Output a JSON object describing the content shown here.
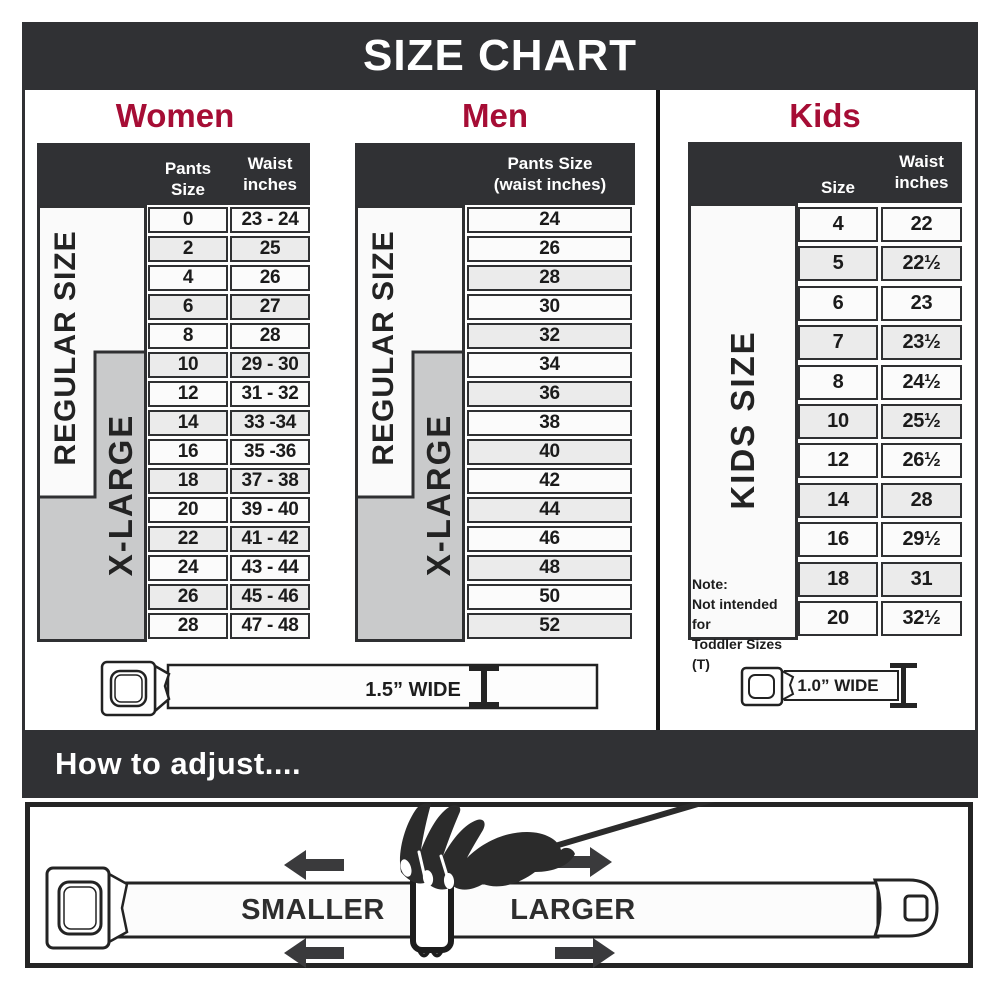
{
  "title": "SIZE CHART",
  "colors": {
    "accent": "#A60D35",
    "charcoal": "#303134",
    "gray_block": "#C9CACB"
  },
  "sections": {
    "women": {
      "heading": "Women",
      "col_size": "Pants Size",
      "col_waist_1": "Waist",
      "col_waist_2": "inches",
      "regular": "REGULAR SIZE",
      "xlarge": "X-LARGE",
      "rows": [
        {
          "size": "0",
          "waist": "23 - 24"
        },
        {
          "size": "2",
          "waist": "25"
        },
        {
          "size": "4",
          "waist": "26"
        },
        {
          "size": "6",
          "waist": "27"
        },
        {
          "size": "8",
          "waist": "28"
        },
        {
          "size": "10",
          "waist": "29 - 30"
        },
        {
          "size": "12",
          "waist": "31 - 32"
        },
        {
          "size": "14",
          "waist": "33 -34"
        },
        {
          "size": "16",
          "waist": "35 -36"
        },
        {
          "size": "18",
          "waist": "37 - 38"
        },
        {
          "size": "20",
          "waist": "39 - 40"
        },
        {
          "size": "22",
          "waist": "41 - 42"
        },
        {
          "size": "24",
          "waist": "43 - 44"
        },
        {
          "size": "26",
          "waist": "45 - 46"
        },
        {
          "size": "28",
          "waist": "47 - 48"
        }
      ]
    },
    "men": {
      "heading": "Men",
      "col_1": "Pants Size",
      "col_2": "(waist inches)",
      "regular": "REGULAR SIZE",
      "xlarge": "X-LARGE",
      "rows": [
        "24",
        "26",
        "28",
        "30",
        "32",
        "34",
        "36",
        "38",
        "40",
        "42",
        "44",
        "46",
        "48",
        "50",
        "52"
      ]
    },
    "kids": {
      "heading": "Kids",
      "col_size": "Size",
      "col_waist_1": "Waist",
      "col_waist_2": "inches",
      "label": "KIDS SIZE",
      "note_1": "Note:",
      "note_2": "Not intended for",
      "note_3": "Toddler Sizes (T)",
      "rows": [
        {
          "size": "4",
          "waist": "22"
        },
        {
          "size": "5",
          "waist": "22½"
        },
        {
          "size": "6",
          "waist": "23"
        },
        {
          "size": "7",
          "waist": "23½"
        },
        {
          "size": "8",
          "waist": "24½"
        },
        {
          "size": "10",
          "waist": "25½"
        },
        {
          "size": "12",
          "waist": "26½"
        },
        {
          "size": "14",
          "waist": "28"
        },
        {
          "size": "16",
          "waist": "29½"
        },
        {
          "size": "18",
          "waist": "31"
        },
        {
          "size": "20",
          "waist": "32½"
        }
      ]
    }
  },
  "belts": {
    "adult": "1.5” WIDE",
    "kids": "1.0” WIDE"
  },
  "adjust": {
    "heading": "How to adjust....",
    "smaller": "SMALLER",
    "larger": "LARGER"
  }
}
